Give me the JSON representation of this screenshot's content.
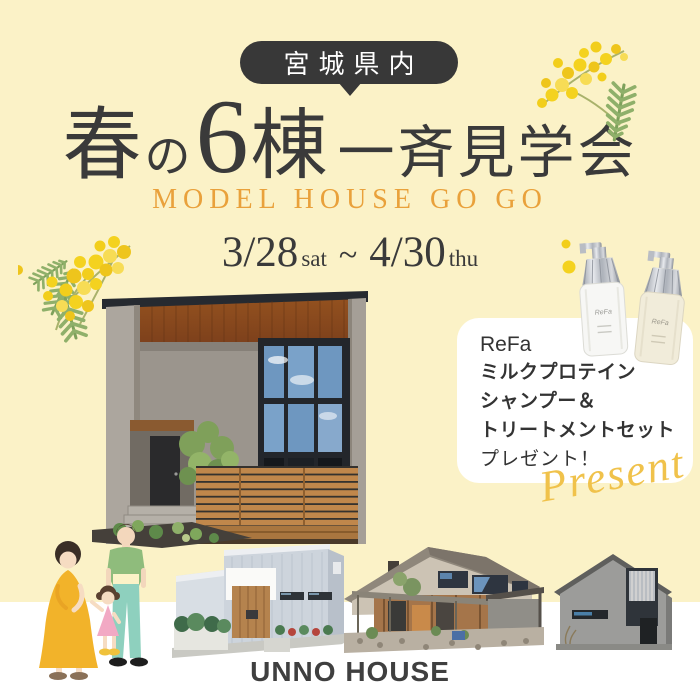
{
  "colors": {
    "background": "#FBF2C7",
    "badge_bg": "#383838",
    "title_text": "#3A3A3A",
    "subtitle_accent": "#E9A13B",
    "present_gold": "#F0C24B",
    "card_bg": "#FFFFFF",
    "mimosa_yellow": "#F2CE1B",
    "mimosa_leaf": "#8FB06A"
  },
  "badge": {
    "label": "宮城県内"
  },
  "title": {
    "segments": [
      "春",
      "の",
      "6",
      "棟",
      "一斉見学会"
    ]
  },
  "subtitle": "MODEL HOUSE GO GO",
  "dates": {
    "start": "3/28",
    "start_day": "sat",
    "separator": "~",
    "end": "4/30",
    "end_day": "thu"
  },
  "gift": {
    "brand": "ReFa",
    "lines": [
      "ミルクプロテイン",
      "シャンプー＆",
      "トリートメントセット"
    ],
    "note": "プレゼント！",
    "script": "Present"
  },
  "logo": "UNNO HOUSE"
}
